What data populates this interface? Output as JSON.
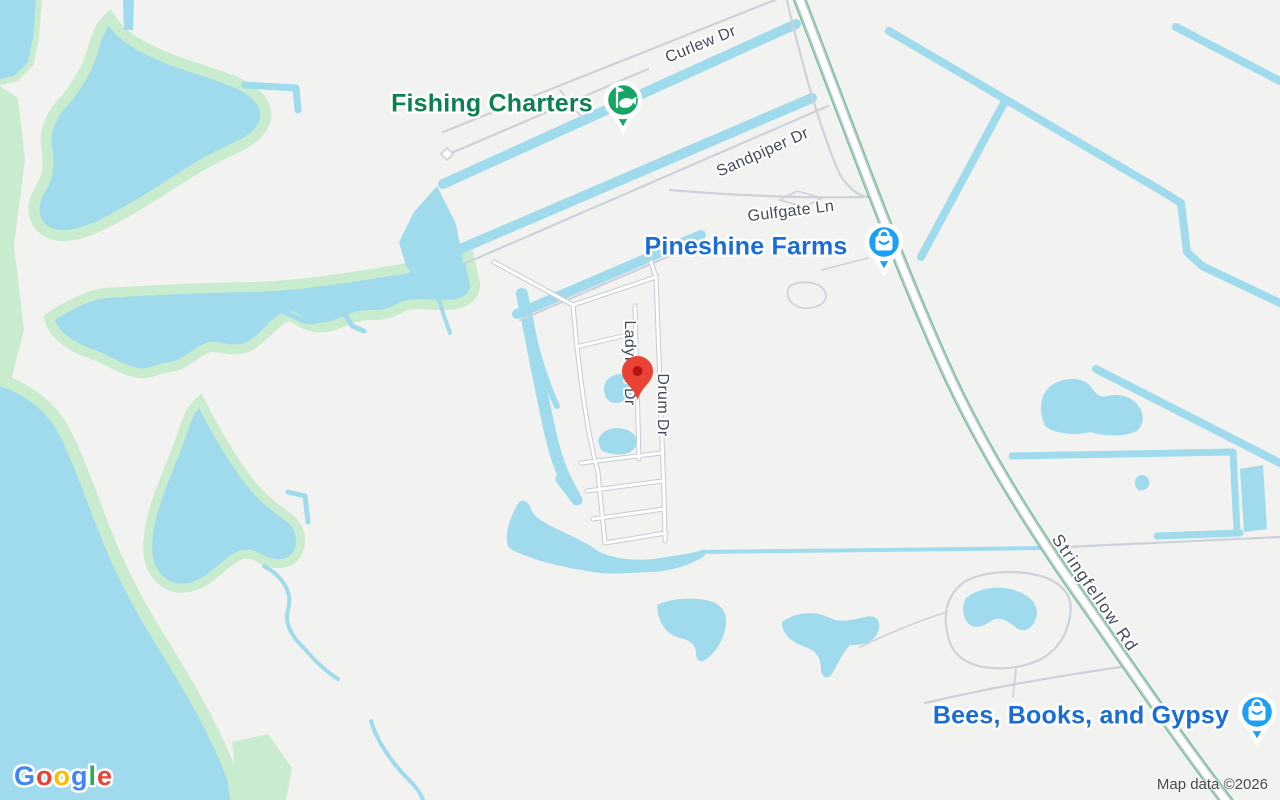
{
  "map": {
    "attribution": "Map data ©2026",
    "google_logo": {
      "letters": [
        "G",
        "o",
        "o",
        "g",
        "l",
        "e"
      ]
    },
    "street_labels": {
      "curlew": "Curlew Dr",
      "sandpiper": "Sandpiper Dr",
      "gulfgate": "Gulfgate Ln",
      "ladyfish": "Ladyfish Dr",
      "drum": "Drum Dr",
      "stringfellow": "Stringfellow Rd"
    },
    "pois": {
      "fishing_charters": {
        "name": "Fishing Charters",
        "category": "fishing-charter",
        "icon": "fish-icon"
      },
      "pineshine_farms": {
        "name": "Pineshine Farms",
        "category": "shopping",
        "icon": "shopping-bag-icon"
      },
      "bees_books_gypsy": {
        "name": "Bees, Books, and Gypsy",
        "category": "shopping",
        "icon": "shopping-bag-icon"
      }
    },
    "marker": {
      "type": "dropped-pin"
    },
    "colors": {
      "land": "#f2f3f0",
      "water": "#9fdbed",
      "vegetation": "#c9ecce",
      "road_minor": "#cdd2da",
      "road_casing": "#c6cbd3",
      "road_fill": "#ffffff",
      "highway_green_edge": "#6cc690",
      "street_label_text": "#444c5b",
      "poi_green_text": "#0d8050",
      "poi_blue_text": "#1a6dd5",
      "pin_green": "#17a464",
      "pin_blue": "#1ba0f5",
      "marker_red": "#ea4335",
      "logo_blue": "#4285F4",
      "logo_red": "#EA4335",
      "logo_yellow": "#FBBC05",
      "logo_green": "#34A853"
    }
  }
}
